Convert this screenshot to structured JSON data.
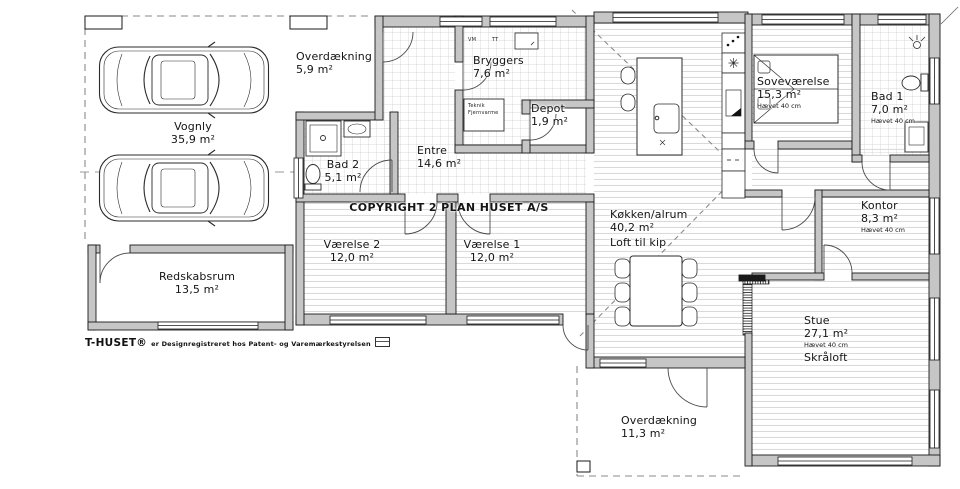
{
  "copyright": "COPYRIGHT 2 PLAN HUSET A/S",
  "footer": {
    "brand": "T-HUSET®",
    "registration_text": "er Designregistreret hos Patent- og Varemærkestyrelsen"
  },
  "appliance_labels": {
    "washing_machine": "VM",
    "dryer": "TT",
    "utility_box_line1": "Teknik",
    "utility_box_line2": "Fjernvarme"
  },
  "rooms": {
    "overdaekning_nw": {
      "name": "Overdækning",
      "area": "5,9 m²"
    },
    "vognly": {
      "name": "Vognly",
      "area": "35,9 m²"
    },
    "bad2": {
      "name": "Bad 2",
      "area": "5,1 m²"
    },
    "entre": {
      "name": "Entre",
      "area": "14,6 m²"
    },
    "bryggers": {
      "name": "Bryggers",
      "area": "7,6 m²"
    },
    "depot": {
      "name": "Depot",
      "area": "1,9 m²"
    },
    "sovevaerelse": {
      "name": "Soveværelse",
      "area": "15,3 m²",
      "note": "Hævet 40 cm"
    },
    "bad1": {
      "name": "Bad 1",
      "area": "7,0 m²",
      "note": "Hævet 40 cm"
    },
    "koekken_alrum": {
      "name": "Køkken/alrum",
      "area": "40,2 m²",
      "note": "Loft til kip"
    },
    "kontor": {
      "name": "Kontor",
      "area": "8,3 m²",
      "note": "Hævet 40 cm"
    },
    "vaerelse2": {
      "name": "Værelse 2",
      "area": "12,0 m²"
    },
    "vaerelse1": {
      "name": "Værelse 1",
      "area": "12,0 m²"
    },
    "redskabsrum": {
      "name": "Redskabsrum",
      "area": "13,5 m²"
    },
    "stue": {
      "name": "Stue",
      "area": "27,1 m²",
      "note": "Hævet 40 cm",
      "note2": "Skråloft"
    },
    "overdaekning_s": {
      "name": "Overdækning",
      "area": "11,3 m²"
    }
  },
  "colors": {
    "line": "#1a1a1a",
    "wall_fill": "#c6c6c6",
    "floor_hatch": "#d4d4d4",
    "tile_hatch": "#cccccc",
    "dash": "#8a8a8a",
    "background": "#ffffff"
  }
}
